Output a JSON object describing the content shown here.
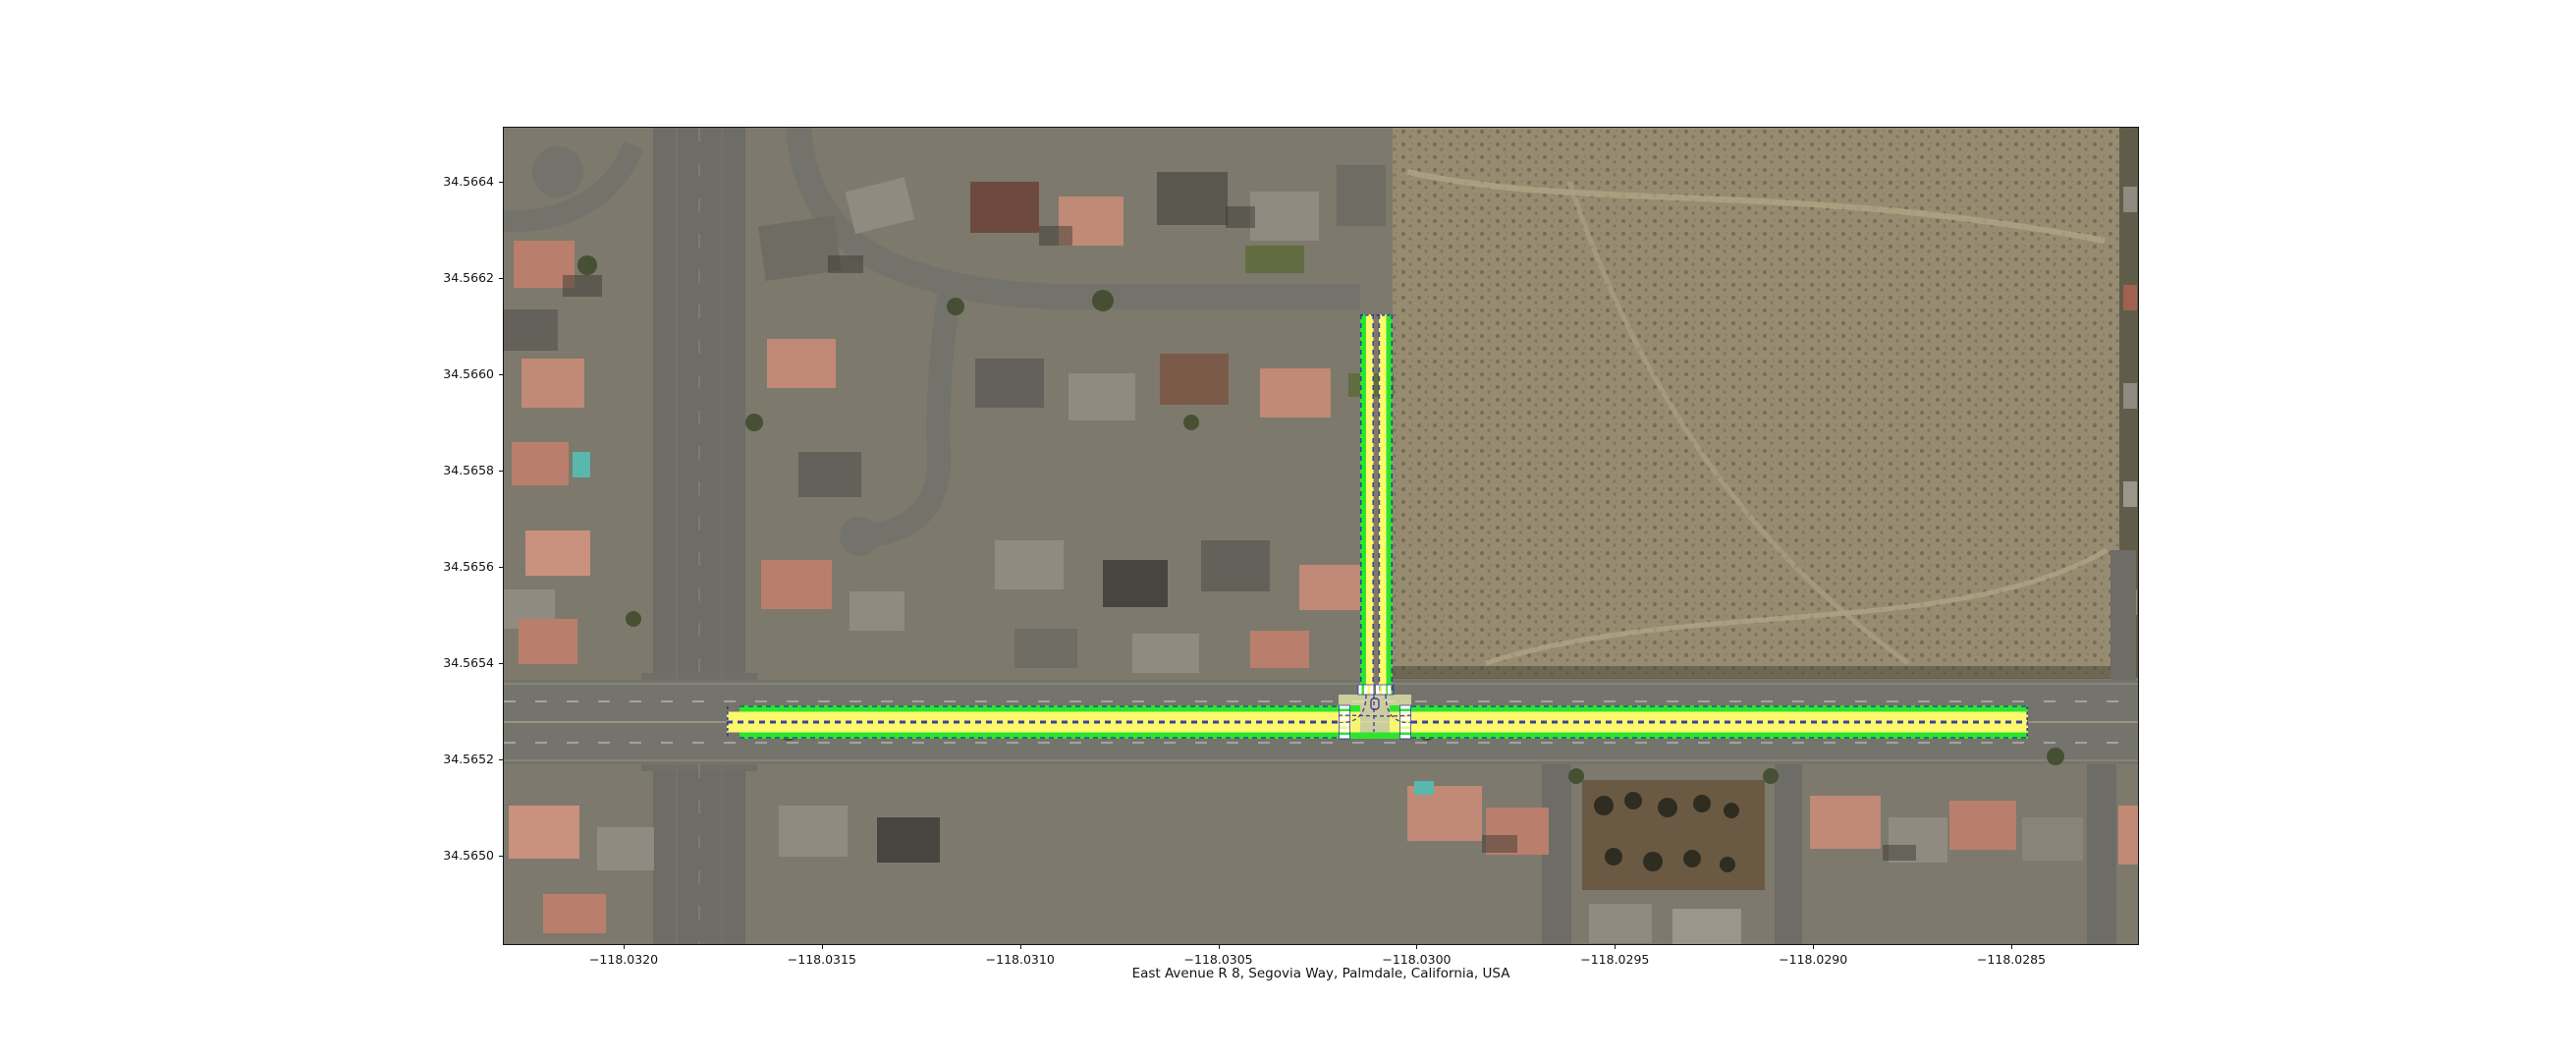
{
  "figure": {
    "title": "East Avenue R 8, Segovia Way, Palmdale, California, USA",
    "x_axis": {
      "ticks": [
        "−118.0320",
        "−118.0315",
        "−118.0310",
        "−118.0305",
        "−118.0300",
        "−118.0295",
        "−118.0290",
        "−118.0285"
      ]
    },
    "y_axis": {
      "ticks": [
        "34.5664",
        "34.5662",
        "34.5660",
        "34.5658",
        "34.5656",
        "34.5654",
        "34.5652",
        "34.5650"
      ]
    }
  },
  "map": {
    "kind": "satellite aerial imagery with road-network overlay",
    "roads_in_title": [
      "East Avenue R 8",
      "Segovia Way"
    ],
    "overlay_colors": {
      "edge_green": "#2ee52e",
      "lane_yellow": "#fcf96d",
      "lane_border_blue": "#2d2da0",
      "crosswalk_white": "#ffffff",
      "junction_fill": "#eef0b0"
    },
    "overlay_features": {
      "junction_type": "T-intersection",
      "vertical_road": "two one-way strips heading north from junction",
      "horizontal_road": "two-direction road running east-west through junction",
      "crosswalks": 3
    }
  }
}
